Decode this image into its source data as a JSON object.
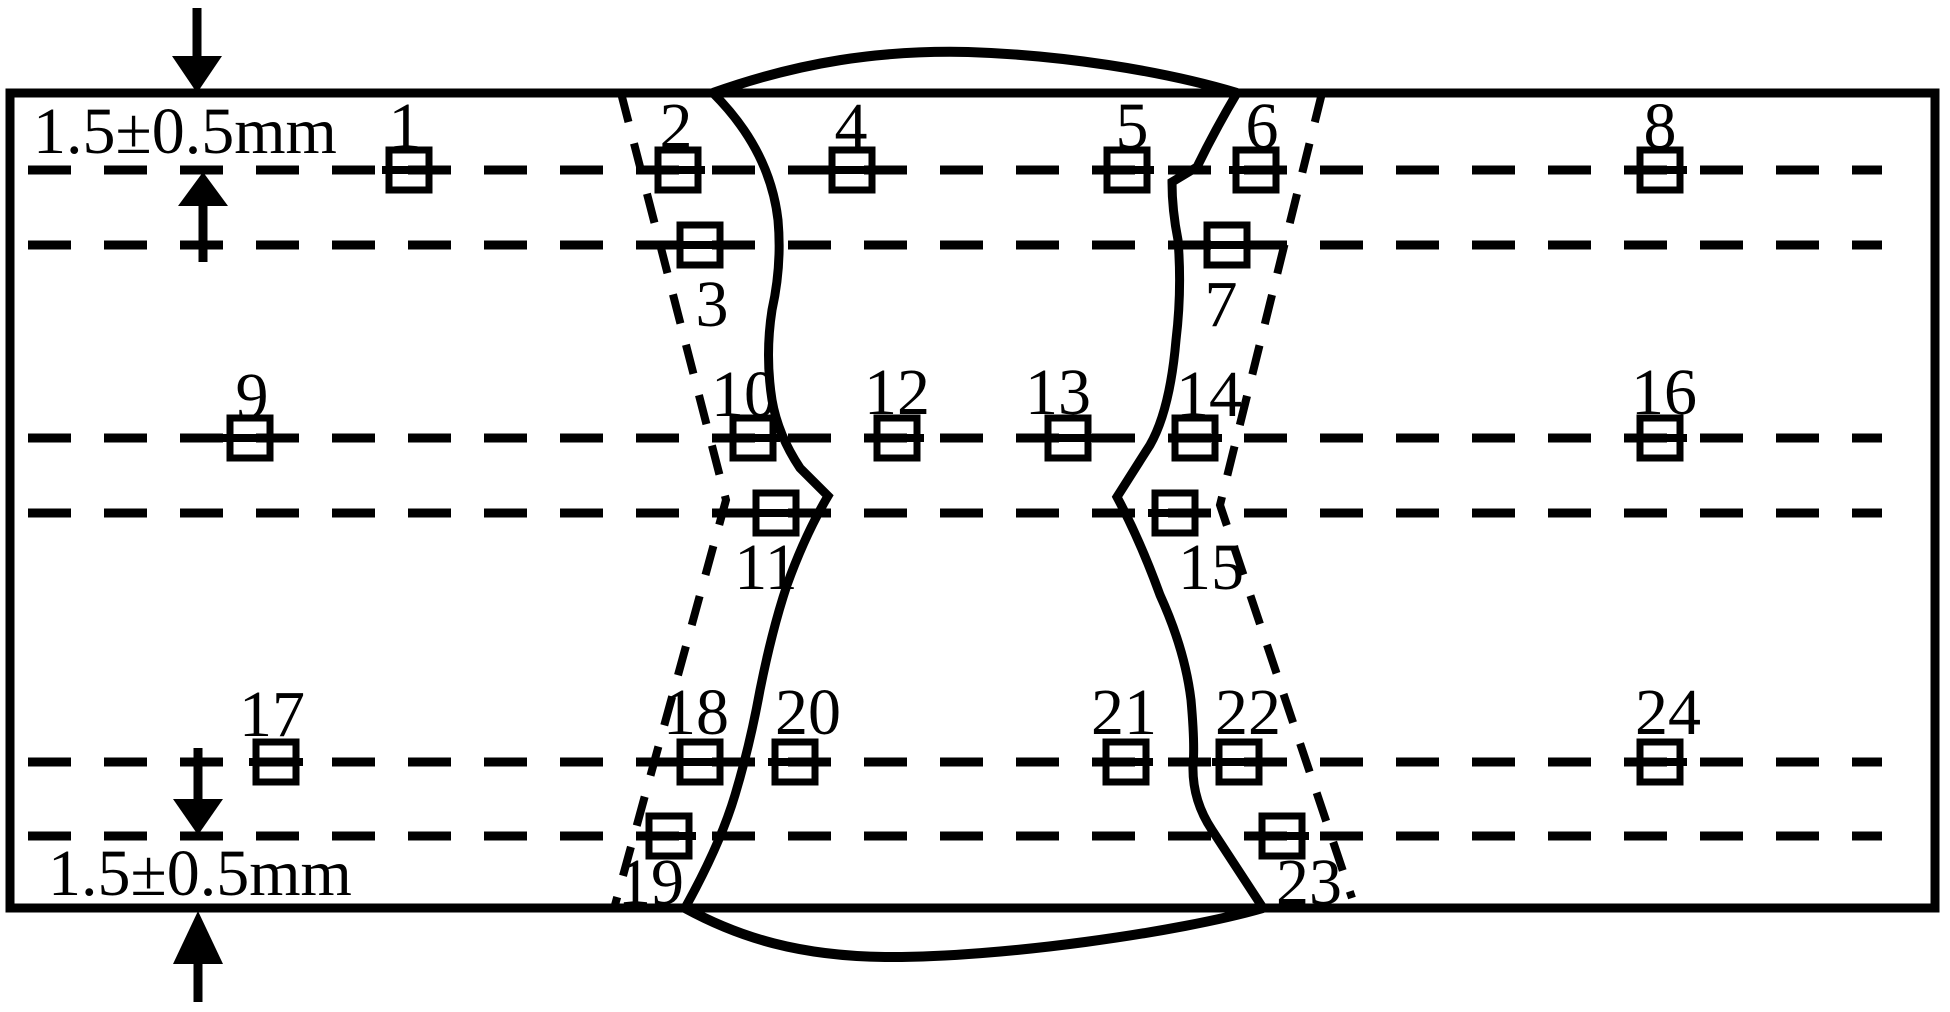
{
  "figure": {
    "description": "Weld joint cross-section diagram with numbered hardness measurement points",
    "dimension_top": "1.5±0.5mm",
    "dimension_bottom": "1.5±0.5mm",
    "line_color": "#000000",
    "background": "#ffffff",
    "rows_y": [
      170,
      245,
      438,
      513,
      762,
      836
    ],
    "points": [
      {
        "label": "1",
        "cx": 409,
        "cy": 170,
        "lx": 405,
        "ly": 148
      },
      {
        "label": "2",
        "cx": 678,
        "cy": 170,
        "lx": 676,
        "ly": 148
      },
      {
        "label": "3",
        "cx": 700,
        "cy": 245,
        "lx": 712,
        "ly": 326
      },
      {
        "label": "4",
        "cx": 852,
        "cy": 170,
        "lx": 851,
        "ly": 148
      },
      {
        "label": "5",
        "cx": 1127,
        "cy": 170,
        "lx": 1132,
        "ly": 148
      },
      {
        "label": "6",
        "cx": 1256,
        "cy": 170,
        "lx": 1262,
        "ly": 148
      },
      {
        "label": "7",
        "cx": 1227,
        "cy": 245,
        "lx": 1221,
        "ly": 326
      },
      {
        "label": "8",
        "cx": 1660,
        "cy": 170,
        "lx": 1660,
        "ly": 148
      },
      {
        "label": "9",
        "cx": 250,
        "cy": 438,
        "lx": 252,
        "ly": 418
      },
      {
        "label": "10",
        "cx": 753,
        "cy": 438,
        "lx": 744,
        "ly": 416
      },
      {
        "label": "11",
        "cx": 776,
        "cy": 513,
        "lx": 766,
        "ly": 589
      },
      {
        "label": "12",
        "cx": 897,
        "cy": 438,
        "lx": 897,
        "ly": 414
      },
      {
        "label": "13",
        "cx": 1068,
        "cy": 438,
        "lx": 1058,
        "ly": 414
      },
      {
        "label": "14",
        "cx": 1195,
        "cy": 438,
        "lx": 1209,
        "ly": 416
      },
      {
        "label": "15",
        "cx": 1175,
        "cy": 513,
        "lx": 1211,
        "ly": 589
      },
      {
        "label": "16",
        "cx": 1660,
        "cy": 438,
        "lx": 1664,
        "ly": 414
      },
      {
        "label": "17",
        "cx": 276,
        "cy": 762,
        "lx": 272,
        "ly": 736
      },
      {
        "label": "18",
        "cx": 700,
        "cy": 762,
        "lx": 696,
        "ly": 734
      },
      {
        "label": "19",
        "cx": 669,
        "cy": 836,
        "lx": 651,
        "ly": 904
      },
      {
        "label": "20",
        "cx": 795,
        "cy": 762,
        "lx": 808,
        "ly": 734
      },
      {
        "label": "21",
        "cx": 1126,
        "cy": 762,
        "lx": 1124,
        "ly": 734
      },
      {
        "label": "22",
        "cx": 1239,
        "cy": 762,
        "lx": 1248,
        "ly": 734
      },
      {
        "label": "23",
        "cx": 1282,
        "cy": 836,
        "lx": 1309,
        "ly": 904
      },
      {
        "label": "24",
        "cx": 1660,
        "cy": 762,
        "lx": 1668,
        "ly": 734
      }
    ]
  }
}
